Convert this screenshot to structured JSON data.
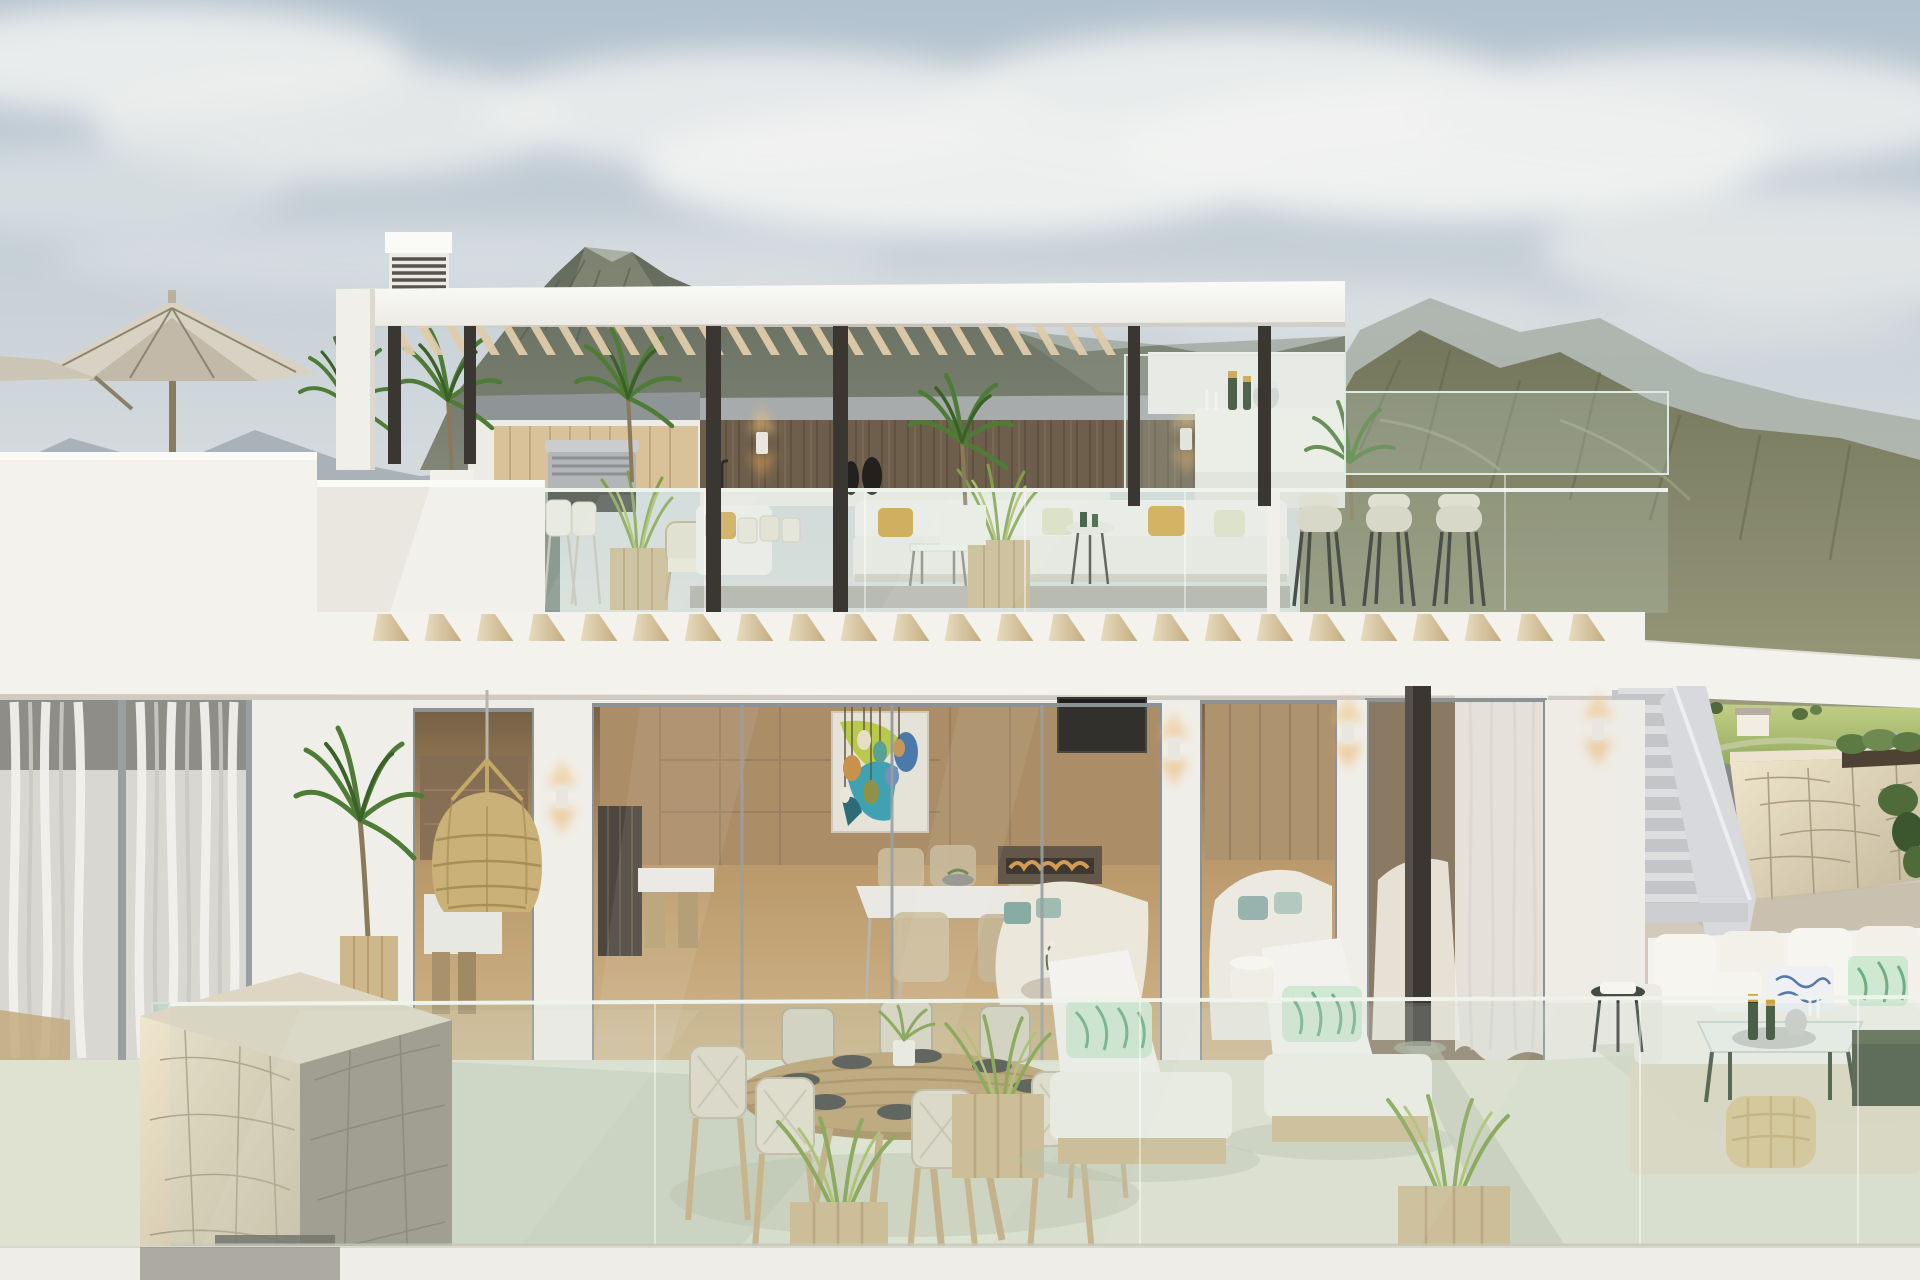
{
  "scene": {
    "type": "architectural-render",
    "description": "Photorealistic 3D rendering of a modern two-storey white luxury villa with rooftop terrace, pergola, glass balustrades and mountain views",
    "time_of_day": "daytime",
    "weather": "partly cloudy",
    "objects": [
      {
        "label": "rooftop pergola with wooden slats and dark bronze columns"
      },
      {
        "label": "louvered chimney vent"
      },
      {
        "label": "beige patio umbrella on left roof terrace"
      },
      {
        "label": "outdoor kitchen with stainless BBQ grill and wood cladding"
      },
      {
        "label": "rooftop lounge sofa with gold and sage cushions"
      },
      {
        "label": "rooftop bar with champagne bottles and cream bar stools"
      },
      {
        "label": "glass balustrades"
      },
      {
        "label": "row of angled wooden roof fins"
      },
      {
        "label": "lower terrace with round outdoor dining table set for six"
      },
      {
        "label": "rattan pendant lamp"
      },
      {
        "label": "sliding glass doors showing interior dining and living rooms"
      },
      {
        "label": "colorful abstract artwork and colored glass pendant cluster"
      },
      {
        "label": "TV lounge with linear fireplace"
      },
      {
        "label": "two white chaise lounges with green leaf-pattern pillows"
      },
      {
        "label": "wooden planters with ornamental grasses"
      },
      {
        "label": "areca palm plants"
      },
      {
        "label": "natural stone clad pillar"
      },
      {
        "label": "exterior staircase with step lights"
      },
      {
        "label": "stone garden wall with planting"
      },
      {
        "label": "outdoor corner sofa with coffee table, champagne and woven pouf"
      },
      {
        "label": "mountain scenery and green golf valley"
      }
    ]
  },
  "palette": {
    "skyTop": "#b3c2cf",
    "skyMid": "#cdd5da",
    "skyLow": "#e5e6e2",
    "cloud": "#edefee",
    "mtnFar": "#a3adb4",
    "mtnMid": "#7f8b84",
    "mtnDark": "#626a5c",
    "mtnLit": "#8f927e",
    "mtnRight": "#7c7f63",
    "mtnRightLit": "#9a9a7c",
    "hillGreen": "#9db368",
    "hillLight": "#c2cf86",
    "pondBlue": "#a6b9ba",
    "wallWhite": "#f4f2ec",
    "wallBright": "#fafaf7",
    "wallShade": "#e5e2db",
    "soffit": "#d8d4cb",
    "woodWall": "#6e5f4c",
    "woodWallLight": "#86755e",
    "pergolaWood": "#decbaa",
    "finWood": "#d3bc92",
    "cabinetWood": "#d9c29a",
    "bronze": "#3a3733",
    "frameGray": "#959ba0",
    "glassEdge": "#e9f0ea",
    "terraceFloor": "#dfe1d1",
    "terraceShadow": "#bcc3ae",
    "rightFloor": "#d2cabb",
    "stoneLight": "#e6ddc6",
    "stoneShade": "#938d7d",
    "stoneCrack": "#9c8f73",
    "plankWood": "#cdb88c",
    "grassGreen": "#7fa045",
    "palmGreen": "#4e7c36",
    "palmDark": "#3a6128",
    "cushionGold": "#d3a647",
    "sageCushion": "#e0e1c2",
    "leafPillow": "#cfe8d2",
    "leafStroke": "#6fae85",
    "bluePattern": "#5577aa",
    "sofaWhite": "#f4f2ee",
    "interiorWarm": "#b8925f",
    "interiorDark": "#6e5335",
    "marbleWhite": "#eceae6",
    "artTeal": "#2f9cb0",
    "artLime": "#b5c93b",
    "artBlue": "#3c70a8",
    "glowAmber": "#e8a850",
    "stairGray": "#ccced2",
    "stairLight": "#dcdee0",
    "rattan": "#c9b177",
    "curtain": "#eceae6",
    "tvBlack": "#201e1b",
    "fireAmber": "#e8a24a",
    "barStool": "#ded7c7",
    "poufTan": "#d9c694",
    "darkGreenFurn": "#46543f"
  }
}
